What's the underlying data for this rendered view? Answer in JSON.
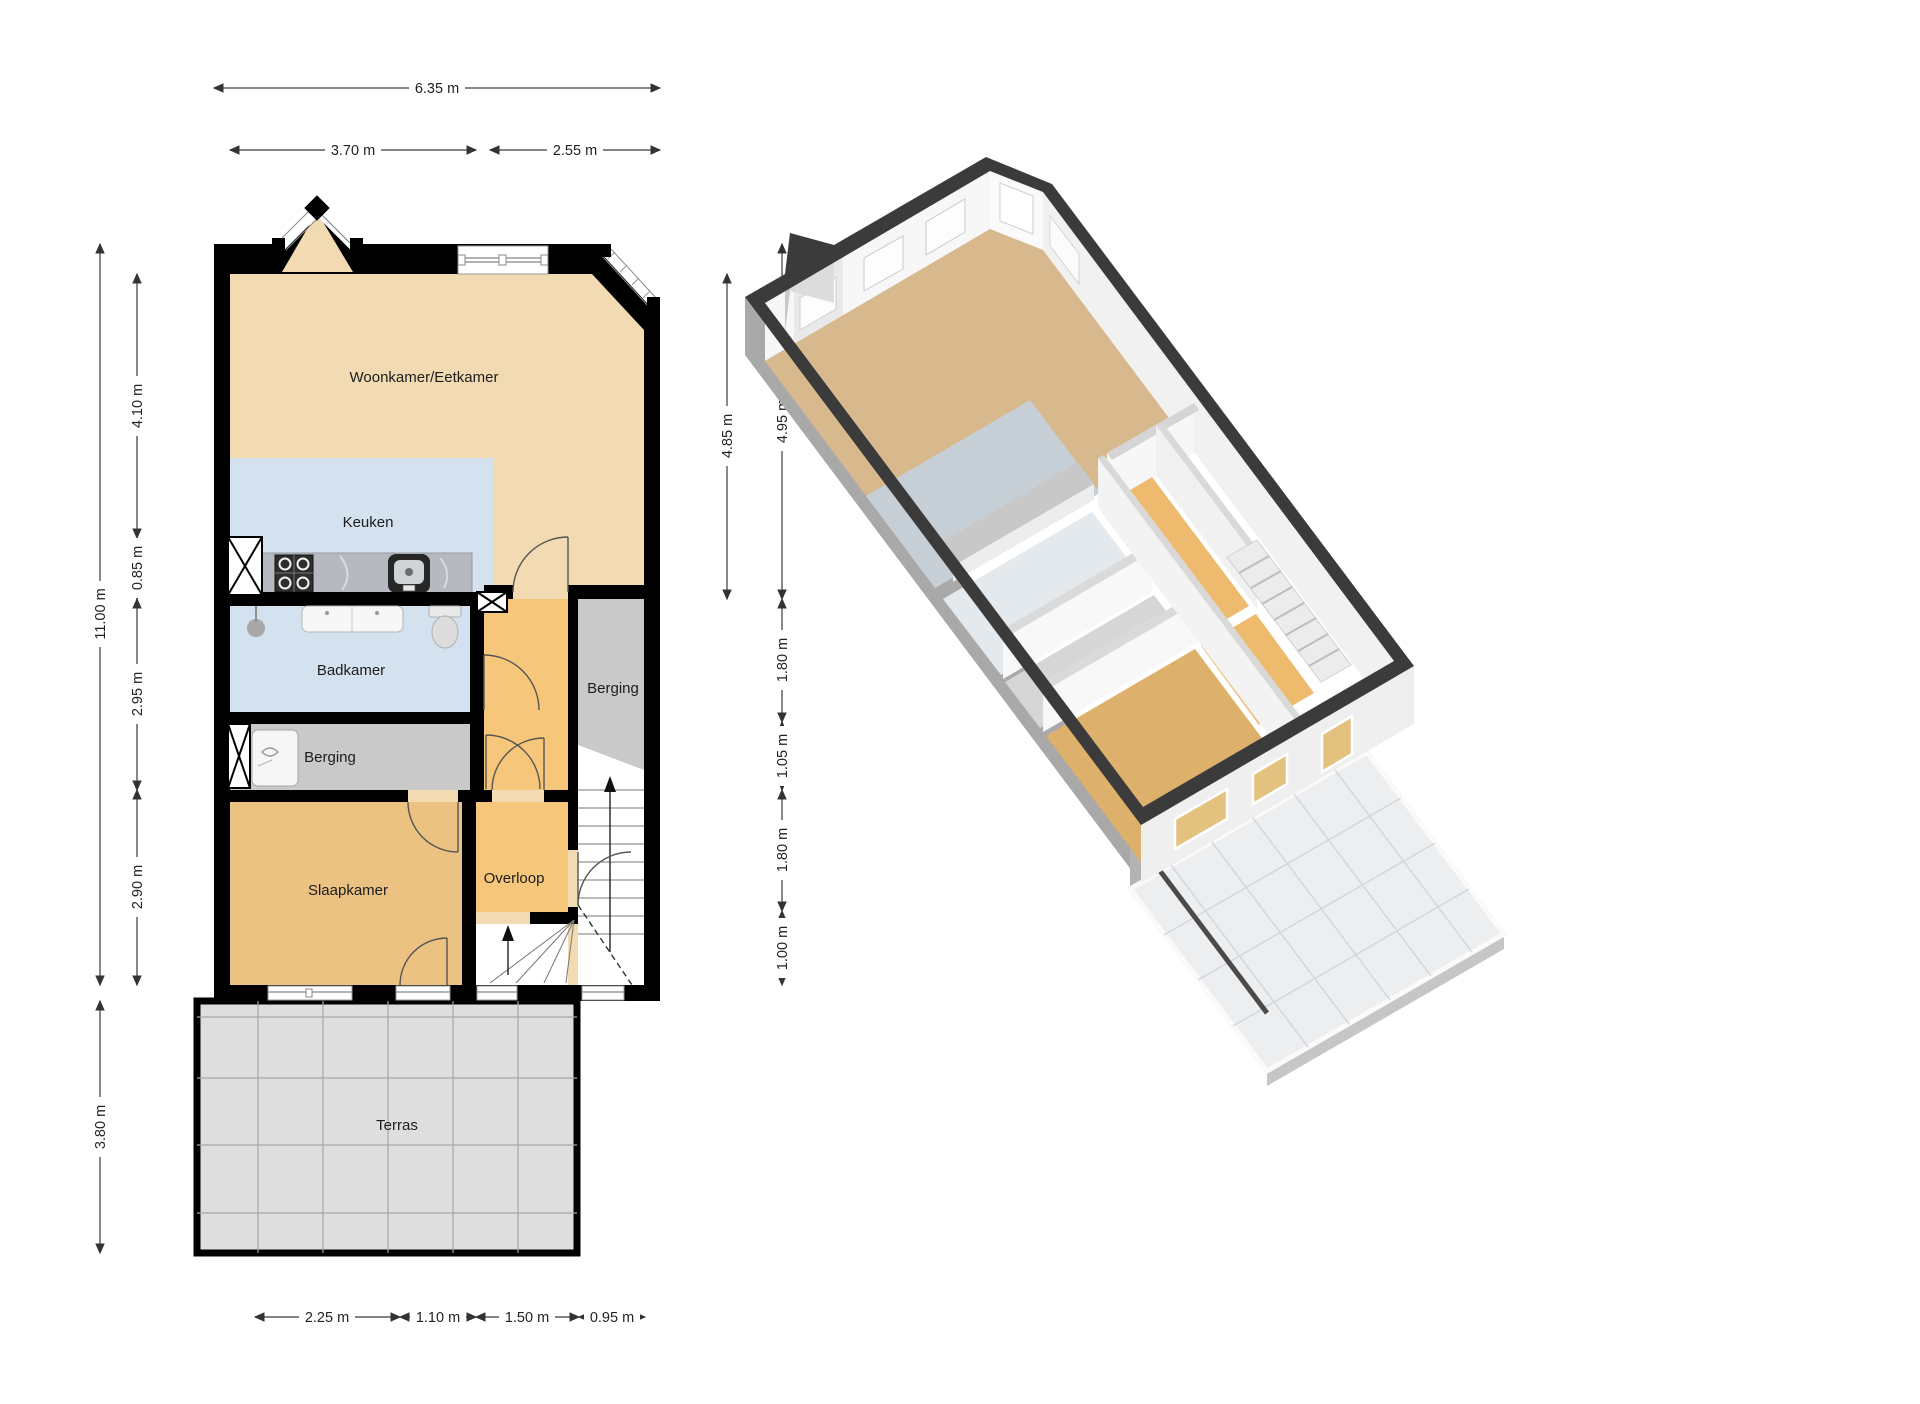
{
  "plan2d": {
    "rooms": {
      "woonkamer": {
        "label": "Woonkamer/Eetkamer"
      },
      "keuken": {
        "label": "Keuken"
      },
      "badkamer": {
        "label": "Badkamer"
      },
      "berging_left": {
        "label": "Berging"
      },
      "berging_right": {
        "label": "Berging"
      },
      "slaapkamer": {
        "label": "Slaapkamer"
      },
      "overloop": {
        "label": "Overloop"
      },
      "terras": {
        "label": "Terras"
      }
    },
    "dimensions": {
      "top_total": "6.35 m",
      "top_left": "3.70 m",
      "top_right": "2.55 m",
      "left_total": "11.00 m",
      "left_1": "4.10 m",
      "left_2": "0.85 m",
      "left_3": "2.95 m",
      "left_4": "2.90 m",
      "left_terras": "3.80 m",
      "right_inner": "4.85 m",
      "right_1": "4.95 m",
      "right_2": "1.80 m",
      "right_3": "1.05 m",
      "right_4": "1.80 m",
      "right_5": "1.00 m",
      "bottom_1": "2.25 m",
      "bottom_2": "1.10 m",
      "bottom_3": "1.50 m",
      "bottom_4": "0.95 m"
    },
    "colors": {
      "floor_tan": "#f2dbb3",
      "floor_blue": "#d4e1ef",
      "floor_orange": "#f6c77b",
      "floor_bedroom": "#ecc283",
      "storage_gray": "#c9c9c9",
      "terras_gray": "#dedede",
      "counter_gray": "#b6bac0",
      "wall_black": "#000000"
    }
  },
  "plan3d": {
    "colors": {
      "wall_top_band": "#3b3b3b",
      "west_face": "#a9a9a9",
      "south_face": "#efefef",
      "inner_wall": "#f7f7f7",
      "floor_tan": "#d8b88d",
      "floor_blue": "#c3d2e2",
      "floor_orange": "#eebb6e",
      "floor_gray": "#d6d6d6",
      "terrace_tile": "#eceef0"
    }
  }
}
